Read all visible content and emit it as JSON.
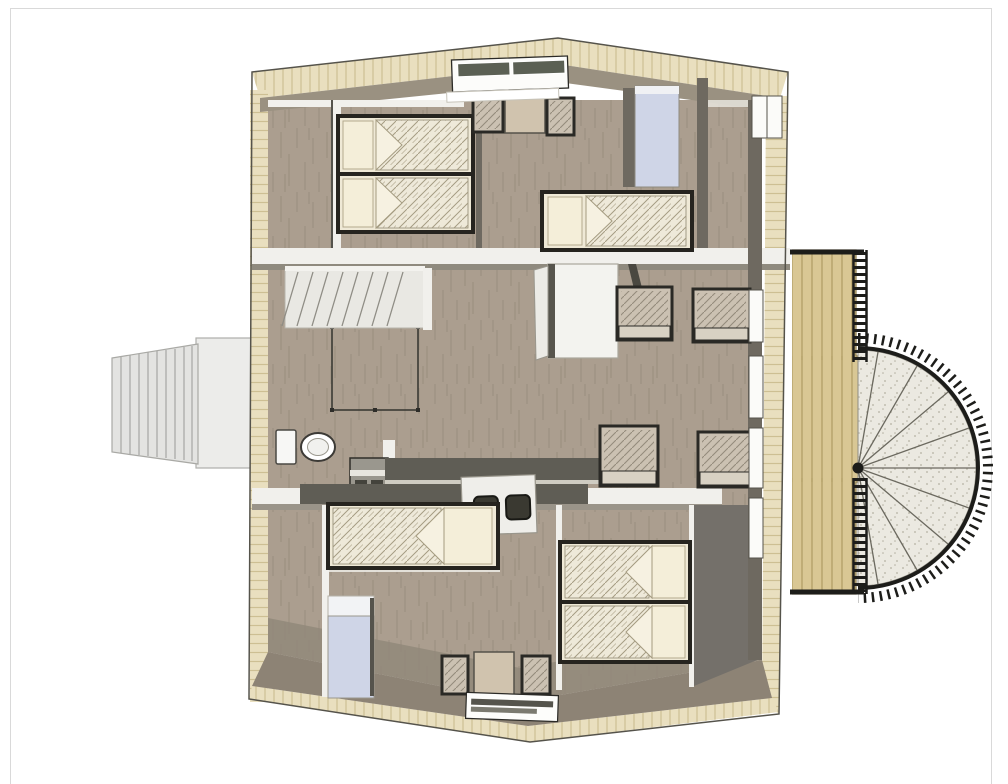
{
  "page": {
    "background": "#ffffff",
    "border_color": "#d9d9d9"
  },
  "palette": {
    "roof_wood": "#e9dfbf",
    "roof_plank_line": "#cdbf93",
    "floor_wood": "#ab9e8f",
    "floor_dark_band": "#8d8375",
    "ceiling_slope_band": "#9a9181",
    "wall_dark": "#6e6960",
    "wall_white": "#f1f0ec",
    "counter_dark": "#5f5d55",
    "bed_frame": "#26241f",
    "bedding_cream": "#efe9d6",
    "wardrobe_blue": "#cfd5e7",
    "cabinet_white": "#f3f3ef",
    "deck_wood": "#d9c794",
    "railing_black": "#1d1d1a",
    "fixture_white": "#fafaf8",
    "spiral_tread": "#ebe9e1",
    "exterior_step_gray": "#e3e3e1"
  },
  "plan": {
    "view": "top-down-3d-rendering",
    "rooms": [
      {
        "name": "bedroom-top-left",
        "furniture": [
          "twin-bed",
          "twin-bed"
        ]
      },
      {
        "name": "bedroom-top-middle",
        "furniture": [
          "single-bed",
          "blue-wardrobe",
          "small-table",
          "chair",
          "chair",
          "roof-skylight"
        ]
      },
      {
        "name": "hall-landing",
        "furniture": [
          "interior-staircase",
          "stair-void-railing",
          "white-cabinet"
        ]
      },
      {
        "name": "bathroom",
        "furniture": [
          "toilet",
          "sink-unit"
        ]
      },
      {
        "name": "kitchen",
        "furniture": [
          "counter",
          "cooktop"
        ]
      },
      {
        "name": "living-area",
        "furniture": [
          "armchair",
          "armchair",
          "armchair",
          "armchair"
        ]
      },
      {
        "name": "bedroom-bottom-left",
        "furniture": [
          "single-bed",
          "blue-wardrobe"
        ]
      },
      {
        "name": "bedroom-bottom-right",
        "furniture": [
          "twin-bed",
          "twin-bed"
        ]
      },
      {
        "name": "dining-nook",
        "furniture": [
          "square-table",
          "chair",
          "chair",
          "roof-window"
        ]
      }
    ],
    "exterior": [
      "gable-roof",
      "entry-steps",
      "entry-landing-platform",
      "balcony-deck",
      "deck-railings",
      "spiral-staircase",
      "facade-windows"
    ]
  }
}
